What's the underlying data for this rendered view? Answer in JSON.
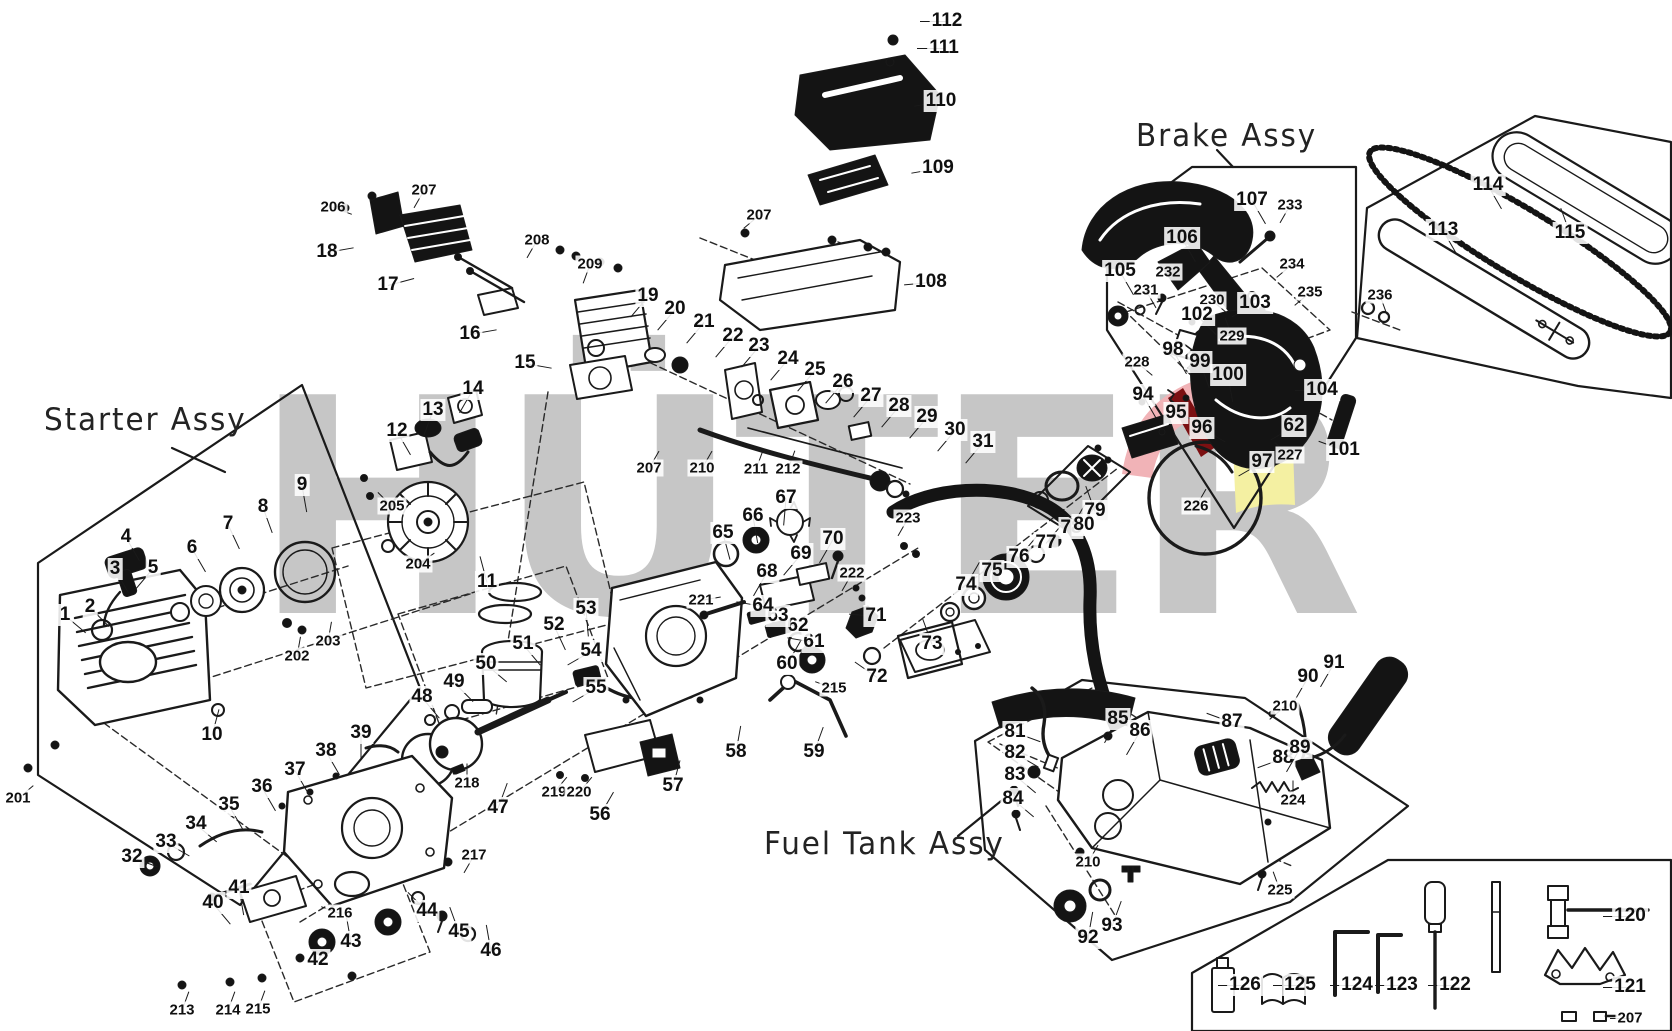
{
  "diagram": {
    "type": "exploded-parts-diagram",
    "product": "chainsaw",
    "ink_color": "#1a1a1a",
    "background": "#ffffff"
  },
  "watermark": {
    "text": "HÜTER",
    "gray": "#c6c6c6",
    "accent_pink": "#f1b3b7",
    "accent_dark_red": "#7c1012",
    "accent_yellow": "#f4f0a2"
  },
  "assemblies": [
    {
      "id": "starter",
      "label": "Starter Assy",
      "x": 44,
      "y": 402
    },
    {
      "id": "brake",
      "label": "Brake Assy",
      "x": 1136,
      "y": 118
    },
    {
      "id": "fuel-tank",
      "label": "Fuel Tank Assy",
      "x": 764,
      "y": 826
    }
  ],
  "parts": [
    {
      "n": "112",
      "x": 947,
      "y": 21,
      "a": 180
    },
    {
      "n": "111",
      "x": 944,
      "y": 48,
      "a": 180
    },
    {
      "n": "110",
      "x": 941,
      "y": 101,
      "a": 170
    },
    {
      "n": "109",
      "x": 938,
      "y": 168,
      "a": 170
    },
    {
      "n": "108",
      "x": 931,
      "y": 282,
      "a": 175
    },
    {
      "n": "207",
      "x": 759,
      "y": 215,
      "a": 140
    },
    {
      "n": "206",
      "x": 333,
      "y": 207,
      "a": 20
    },
    {
      "n": "207",
      "x": 424,
      "y": 190,
      "a": 120
    },
    {
      "n": "18",
      "x": 327,
      "y": 252,
      "a": 350
    },
    {
      "n": "17",
      "x": 388,
      "y": 285,
      "a": 345
    },
    {
      "n": "16",
      "x": 470,
      "y": 334,
      "a": 350
    },
    {
      "n": "208",
      "x": 537,
      "y": 240,
      "a": 120
    },
    {
      "n": "209",
      "x": 590,
      "y": 264,
      "a": 110
    },
    {
      "n": "15",
      "x": 525,
      "y": 363,
      "a": 10
    },
    {
      "n": "19",
      "x": 648,
      "y": 296,
      "a": 130
    },
    {
      "n": "20",
      "x": 675,
      "y": 309,
      "a": 130
    },
    {
      "n": "21",
      "x": 704,
      "y": 322,
      "a": 130
    },
    {
      "n": "22",
      "x": 733,
      "y": 336,
      "a": 130
    },
    {
      "n": "23",
      "x": 759,
      "y": 346,
      "a": 130
    },
    {
      "n": "24",
      "x": 788,
      "y": 359,
      "a": 130
    },
    {
      "n": "25",
      "x": 815,
      "y": 370,
      "a": 130
    },
    {
      "n": "26",
      "x": 843,
      "y": 382,
      "a": 130
    },
    {
      "n": "27",
      "x": 871,
      "y": 396,
      "a": 130
    },
    {
      "n": "28",
      "x": 899,
      "y": 406,
      "a": 130
    },
    {
      "n": "29",
      "x": 927,
      "y": 417,
      "a": 130
    },
    {
      "n": "30",
      "x": 955,
      "y": 430,
      "a": 130
    },
    {
      "n": "31",
      "x": 983,
      "y": 442,
      "a": 130
    },
    {
      "n": "207",
      "x": 649,
      "y": 468,
      "a": 300
    },
    {
      "n": "210",
      "x": 702,
      "y": 468,
      "a": 300
    },
    {
      "n": "211",
      "x": 756,
      "y": 469,
      "a": 290
    },
    {
      "n": "212",
      "x": 788,
      "y": 469,
      "a": 290
    },
    {
      "n": "12",
      "x": 397,
      "y": 431,
      "a": 60
    },
    {
      "n": "13",
      "x": 433,
      "y": 410,
      "a": 110
    },
    {
      "n": "14",
      "x": 473,
      "y": 389,
      "a": 120
    },
    {
      "n": "205",
      "x": 392,
      "y": 506,
      "a": 225
    },
    {
      "n": "204",
      "x": 418,
      "y": 564,
      "a": 325
    },
    {
      "n": "11",
      "x": 487,
      "y": 582,
      "a": 255
    },
    {
      "n": "9",
      "x": 302,
      "y": 485,
      "a": 80
    },
    {
      "n": "8",
      "x": 263,
      "y": 507,
      "a": 70
    },
    {
      "n": "7",
      "x": 228,
      "y": 524,
      "a": 65
    },
    {
      "n": "6",
      "x": 192,
      "y": 548,
      "a": 60
    },
    {
      "n": "5",
      "x": 153,
      "y": 568,
      "a": 130
    },
    {
      "n": "4",
      "x": 126,
      "y": 537,
      "a": 60
    },
    {
      "n": "3",
      "x": 115,
      "y": 569,
      "a": 60
    },
    {
      "n": "2",
      "x": 90,
      "y": 607,
      "a": 45
    },
    {
      "n": "1",
      "x": 65,
      "y": 615,
      "a": 40
    },
    {
      "n": "10",
      "x": 212,
      "y": 735,
      "a": 285
    },
    {
      "n": "201",
      "x": 18,
      "y": 798,
      "a": 320
    },
    {
      "n": "202",
      "x": 297,
      "y": 656,
      "a": 280
    },
    {
      "n": "203",
      "x": 328,
      "y": 641,
      "a": 280
    },
    {
      "n": "48",
      "x": 422,
      "y": 697,
      "a": 50
    },
    {
      "n": "49",
      "x": 454,
      "y": 682,
      "a": 45
    },
    {
      "n": "50",
      "x": 486,
      "y": 664,
      "a": 40
    },
    {
      "n": "51",
      "x": 523,
      "y": 644,
      "a": 50
    },
    {
      "n": "52",
      "x": 554,
      "y": 625,
      "a": 65
    },
    {
      "n": "53",
      "x": 586,
      "y": 609,
      "a": 85
    },
    {
      "n": "54",
      "x": 591,
      "y": 651,
      "a": 150
    },
    {
      "n": "55",
      "x": 596,
      "y": 688,
      "a": 150
    },
    {
      "n": "219",
      "x": 554,
      "y": 792,
      "a": 310
    },
    {
      "n": "220",
      "x": 579,
      "y": 792,
      "a": 310
    },
    {
      "n": "56",
      "x": 600,
      "y": 815,
      "a": 300
    },
    {
      "n": "57",
      "x": 673,
      "y": 786,
      "a": 285
    },
    {
      "n": "58",
      "x": 736,
      "y": 752,
      "a": 280
    },
    {
      "n": "59",
      "x": 814,
      "y": 752,
      "a": 290
    },
    {
      "n": "60",
      "x": 787,
      "y": 664,
      "a": 300
    },
    {
      "n": "61",
      "x": 814,
      "y": 642,
      "a": 190
    },
    {
      "n": "62",
      "x": 798,
      "y": 626,
      "a": 190
    },
    {
      "n": "63",
      "x": 778,
      "y": 616,
      "a": 190
    },
    {
      "n": "64",
      "x": 763,
      "y": 606,
      "a": 190
    },
    {
      "n": "215",
      "x": 834,
      "y": 688,
      "a": 200
    },
    {
      "n": "221",
      "x": 701,
      "y": 600,
      "a": 350
    },
    {
      "n": "65",
      "x": 723,
      "y": 533,
      "a": 75
    },
    {
      "n": "66",
      "x": 753,
      "y": 516,
      "a": 80
    },
    {
      "n": "67",
      "x": 786,
      "y": 498,
      "a": 95
    },
    {
      "n": "68",
      "x": 767,
      "y": 572,
      "a": 120
    },
    {
      "n": "69",
      "x": 801,
      "y": 554,
      "a": 130
    },
    {
      "n": "70",
      "x": 833,
      "y": 539,
      "a": 120
    },
    {
      "n": "222",
      "x": 852,
      "y": 573,
      "a": 120
    },
    {
      "n": "71",
      "x": 876,
      "y": 616,
      "a": 185
    },
    {
      "n": "72",
      "x": 877,
      "y": 677,
      "a": 215
    },
    {
      "n": "223",
      "x": 908,
      "y": 518,
      "a": 120
    },
    {
      "n": "47",
      "x": 498,
      "y": 808,
      "a": 290
    },
    {
      "n": "218",
      "x": 467,
      "y": 783,
      "a": 270
    },
    {
      "n": "73",
      "x": 932,
      "y": 644,
      "a": 250
    },
    {
      "n": "74",
      "x": 966,
      "y": 585,
      "a": 300
    },
    {
      "n": "75",
      "x": 992,
      "y": 571,
      "a": 310
    },
    {
      "n": "76",
      "x": 1019,
      "y": 557,
      "a": 310
    },
    {
      "n": "77",
      "x": 1046,
      "y": 543,
      "a": 310
    },
    {
      "n": "78",
      "x": 1071,
      "y": 528,
      "a": 300
    },
    {
      "n": "79",
      "x": 1095,
      "y": 511,
      "a": 250
    },
    {
      "n": "80",
      "x": 1084,
      "y": 525,
      "a": 210
    },
    {
      "n": "32",
      "x": 132,
      "y": 857,
      "a": 20
    },
    {
      "n": "33",
      "x": 166,
      "y": 842,
      "a": 30
    },
    {
      "n": "34",
      "x": 196,
      "y": 824,
      "a": 40
    },
    {
      "n": "35",
      "x": 229,
      "y": 805,
      "a": 60
    },
    {
      "n": "36",
      "x": 262,
      "y": 787,
      "a": 60
    },
    {
      "n": "37",
      "x": 295,
      "y": 770,
      "a": 60
    },
    {
      "n": "38",
      "x": 326,
      "y": 751,
      "a": 60
    },
    {
      "n": "39",
      "x": 361,
      "y": 733,
      "a": 90
    },
    {
      "n": "40",
      "x": 213,
      "y": 903,
      "a": 50
    },
    {
      "n": "41",
      "x": 239,
      "y": 888,
      "a": 80
    },
    {
      "n": "42",
      "x": 318,
      "y": 960,
      "a": 300
    },
    {
      "n": "43",
      "x": 351,
      "y": 942,
      "a": 260
    },
    {
      "n": "44",
      "x": 427,
      "y": 911,
      "a": 225
    },
    {
      "n": "45",
      "x": 459,
      "y": 932,
      "a": 250
    },
    {
      "n": "46",
      "x": 491,
      "y": 951,
      "a": 260
    },
    {
      "n": "216",
      "x": 340,
      "y": 913,
      "a": 200
    },
    {
      "n": "217",
      "x": 474,
      "y": 855,
      "a": 120
    },
    {
      "n": "213",
      "x": 182,
      "y": 1010,
      "a": 290
    },
    {
      "n": "214",
      "x": 228,
      "y": 1010,
      "a": 290
    },
    {
      "n": "215",
      "x": 258,
      "y": 1009,
      "a": 290
    },
    {
      "n": "81",
      "x": 1015,
      "y": 732,
      "a": 20
    },
    {
      "n": "82",
      "x": 1015,
      "y": 753,
      "a": 30
    },
    {
      "n": "83",
      "x": 1015,
      "y": 775,
      "a": 40
    },
    {
      "n": "84",
      "x": 1013,
      "y": 799,
      "a": 40
    },
    {
      "n": "85",
      "x": 1118,
      "y": 719,
      "a": 120
    },
    {
      "n": "86",
      "x": 1140,
      "y": 731,
      "a": 120
    },
    {
      "n": "87",
      "x": 1232,
      "y": 722,
      "a": 200
    },
    {
      "n": "88",
      "x": 1283,
      "y": 758,
      "a": 160
    },
    {
      "n": "89",
      "x": 1300,
      "y": 748,
      "a": 120
    },
    {
      "n": "90",
      "x": 1308,
      "y": 677,
      "a": 120
    },
    {
      "n": "91",
      "x": 1334,
      "y": 663,
      "a": 120
    },
    {
      "n": "210",
      "x": 1285,
      "y": 706,
      "a": 140
    },
    {
      "n": "210",
      "x": 1088,
      "y": 862,
      "a": 300
    },
    {
      "n": "224",
      "x": 1293,
      "y": 800,
      "a": 270
    },
    {
      "n": "225",
      "x": 1280,
      "y": 890,
      "a": 250
    },
    {
      "n": "92",
      "x": 1088,
      "y": 938,
      "a": 280
    },
    {
      "n": "93",
      "x": 1112,
      "y": 926,
      "a": 290
    },
    {
      "n": "94",
      "x": 1143,
      "y": 395,
      "a": 60
    },
    {
      "n": "95",
      "x": 1176,
      "y": 413,
      "a": 20
    },
    {
      "n": "96",
      "x": 1202,
      "y": 428,
      "a": 30
    },
    {
      "n": "97",
      "x": 1262,
      "y": 462,
      "a": 150
    },
    {
      "n": "98",
      "x": 1173,
      "y": 350,
      "a": 60
    },
    {
      "n": "99",
      "x": 1200,
      "y": 362,
      "a": 70
    },
    {
      "n": "100",
      "x": 1228,
      "y": 375,
      "a": 80
    },
    {
      "n": "226",
      "x": 1196,
      "y": 506,
      "a": 300
    },
    {
      "n": "227",
      "x": 1290,
      "y": 455,
      "a": 220
    },
    {
      "n": "228",
      "x": 1137,
      "y": 362,
      "a": 40
    },
    {
      "n": "229",
      "x": 1232,
      "y": 336,
      "a": 250
    },
    {
      "n": "230",
      "x": 1212,
      "y": 300,
      "a": 40
    },
    {
      "n": "231",
      "x": 1146,
      "y": 290,
      "a": 60
    },
    {
      "n": "232",
      "x": 1168,
      "y": 272,
      "a": 60
    },
    {
      "n": "233",
      "x": 1290,
      "y": 205,
      "a": 120
    },
    {
      "n": "234",
      "x": 1292,
      "y": 264,
      "a": 140
    },
    {
      "n": "235",
      "x": 1310,
      "y": 292,
      "a": 140
    },
    {
      "n": "101",
      "x": 1344,
      "y": 450,
      "a": 200
    },
    {
      "n": "102",
      "x": 1197,
      "y": 315,
      "a": 45
    },
    {
      "n": "103",
      "x": 1255,
      "y": 303,
      "a": 150
    },
    {
      "n": "104",
      "x": 1322,
      "y": 390,
      "a": 180
    },
    {
      "n": "105",
      "x": 1120,
      "y": 271,
      "a": 60
    },
    {
      "n": "106",
      "x": 1182,
      "y": 238,
      "a": 60
    },
    {
      "n": "107",
      "x": 1252,
      "y": 200,
      "a": 60
    },
    {
      "n": "62",
      "x": 1294,
      "y": 426,
      "a": 150
    },
    {
      "n": "113",
      "x": 1443,
      "y": 230,
      "a": 60
    },
    {
      "n": "114",
      "x": 1488,
      "y": 185,
      "a": 60
    },
    {
      "n": "115",
      "x": 1570,
      "y": 233,
      "a": 250
    },
    {
      "n": "236",
      "x": 1380,
      "y": 295,
      "a": 70
    },
    {
      "n": "120",
      "x": 1630,
      "y": 916,
      "a": 180
    },
    {
      "n": "121",
      "x": 1630,
      "y": 987,
      "a": 180
    },
    {
      "n": "122",
      "x": 1455,
      "y": 985,
      "a": 180
    },
    {
      "n": "123",
      "x": 1402,
      "y": 985,
      "a": 180
    },
    {
      "n": "124",
      "x": 1357,
      "y": 985,
      "a": 180
    },
    {
      "n": "125",
      "x": 1300,
      "y": 985,
      "a": 180
    },
    {
      "n": "126",
      "x": 1245,
      "y": 985,
      "a": 180
    },
    {
      "n": "207",
      "x": 1630,
      "y": 1018,
      "a": 180
    }
  ]
}
